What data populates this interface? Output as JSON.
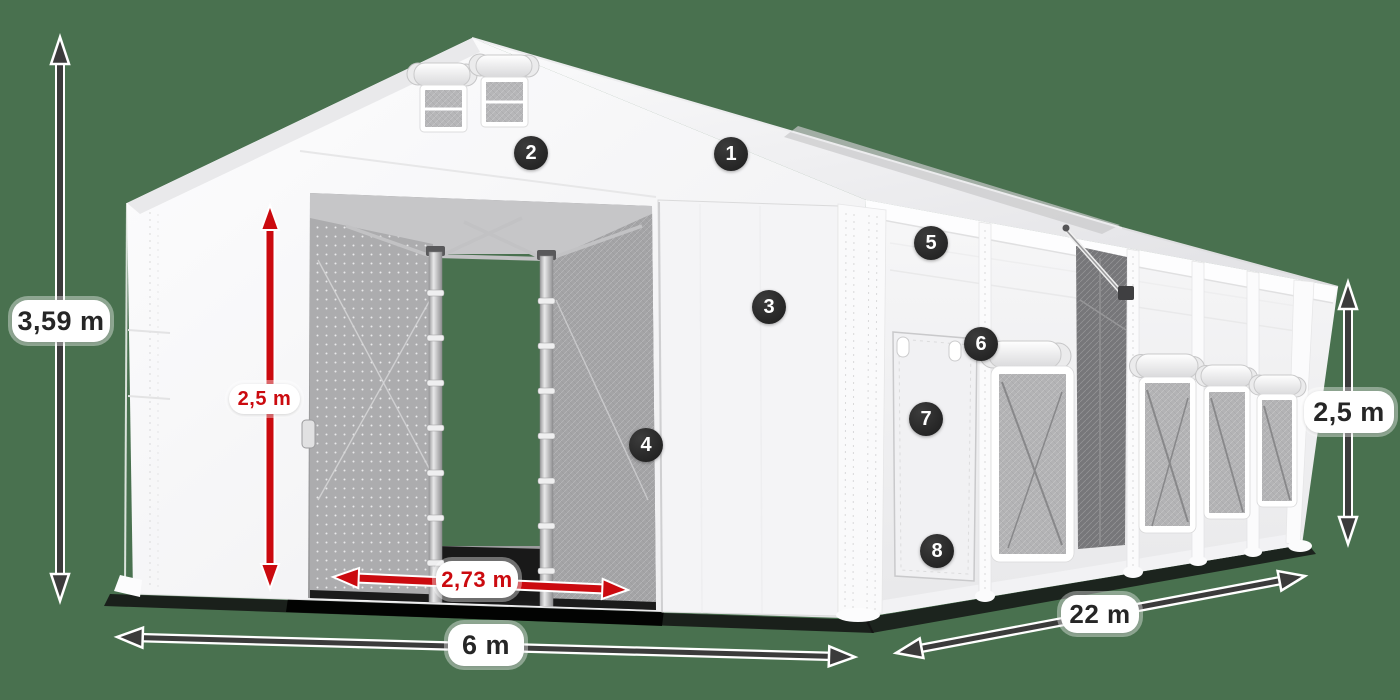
{
  "scene": {
    "description": "3D product illustration of a white tarpaulin storage tent (6 m x 22 m) with open front entrance, side door and mesh windows, annotated with dimensions and numbered feature callouts",
    "background_color": "#49714f",
    "red_accent_color": "#cb0a0f",
    "dark_arrow_color": "#3b3b3b",
    "badge_color": "#2a2a2a"
  },
  "dimensions": {
    "total_height": {
      "label": "3,59 m",
      "style": "outer-dark",
      "axis": "vertical",
      "position": "left"
    },
    "entrance_height": {
      "label": "2,5 m",
      "style": "inner-red",
      "axis": "vertical",
      "position": "front-entrance"
    },
    "entrance_width": {
      "label": "2,73 m",
      "style": "inner-red",
      "axis": "horizontal",
      "position": "front-entrance"
    },
    "front_width": {
      "label": "6 m",
      "style": "outer-dark",
      "axis": "horizontal",
      "position": "bottom-front"
    },
    "side_length": {
      "label": "22 m",
      "style": "outer-dark",
      "axis": "diagonal",
      "position": "bottom-side"
    },
    "side_height": {
      "label": "2,5 m",
      "style": "outer-dark",
      "axis": "vertical",
      "position": "right-side"
    }
  },
  "callouts": [
    {
      "number": "1",
      "area": "roof tarpaulin"
    },
    {
      "number": "2",
      "area": "front gable header"
    },
    {
      "number": "3",
      "area": "front wall panel"
    },
    {
      "number": "4",
      "area": "entrance door edge"
    },
    {
      "number": "5",
      "area": "side wall upper panel"
    },
    {
      "number": "6",
      "area": "side window roll-up"
    },
    {
      "number": "7",
      "area": "side entrance door"
    },
    {
      "number": "8",
      "area": "side door bottom"
    }
  ]
}
